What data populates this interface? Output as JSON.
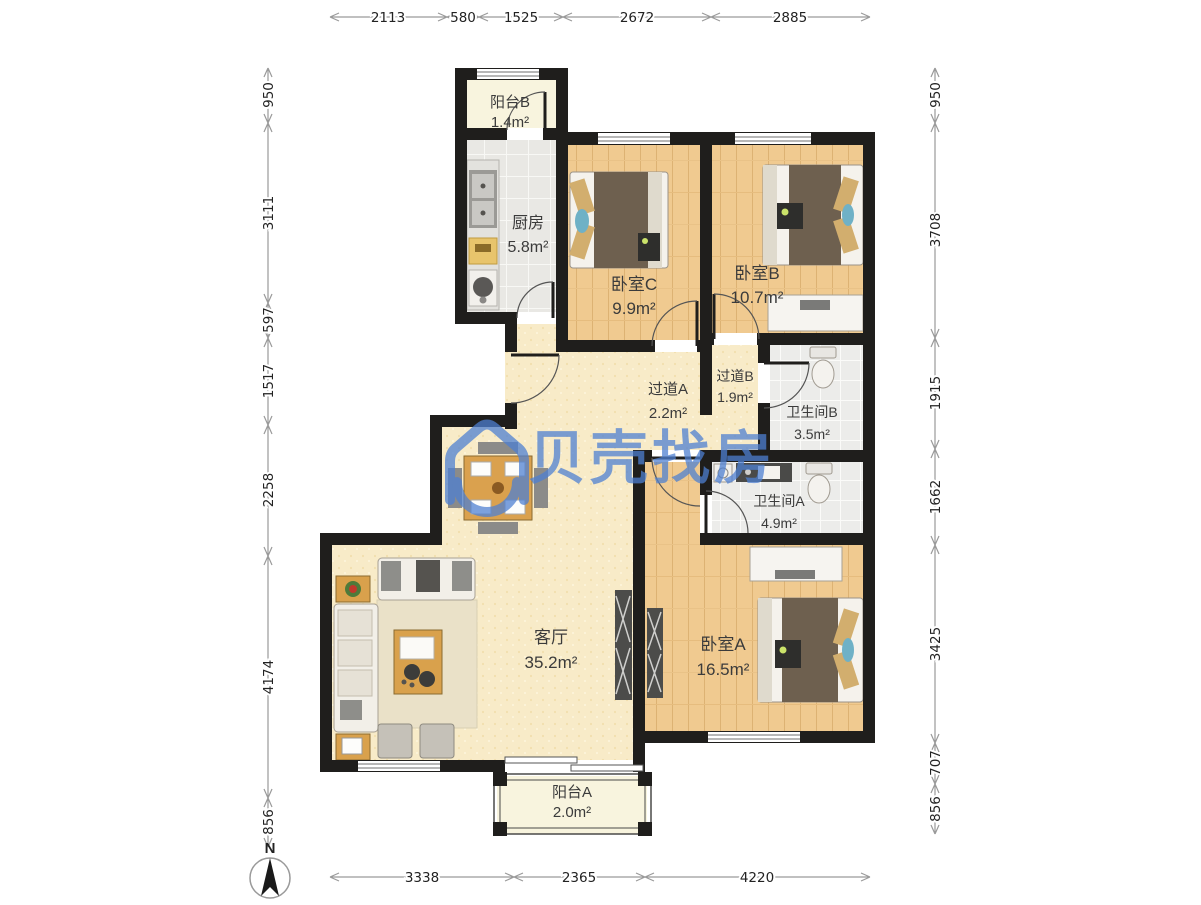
{
  "watermark": {
    "brand": "贝壳找房"
  },
  "compass": {
    "label": "N"
  },
  "rooms": [
    {
      "id": "balcony-b",
      "name": "阳台B",
      "area": "1.4m²"
    },
    {
      "id": "kitchen",
      "name": "厨房",
      "area": "5.8m²"
    },
    {
      "id": "bedroom-c",
      "name": "卧室C",
      "area": "9.9m²"
    },
    {
      "id": "bedroom-b",
      "name": "卧室B",
      "area": "10.7m²"
    },
    {
      "id": "hallway-a",
      "name": "过道A",
      "area": "2.2m²"
    },
    {
      "id": "hallway-b",
      "name": "过道B",
      "area": "1.9m²"
    },
    {
      "id": "bathroom-b",
      "name": "卫生间B",
      "area": "3.5m²"
    },
    {
      "id": "bathroom-a",
      "name": "卫生间A",
      "area": "4.9m²"
    },
    {
      "id": "living-room",
      "name": "客厅",
      "area": "35.2m²"
    },
    {
      "id": "bedroom-a",
      "name": "卧室A",
      "area": "16.5m²"
    },
    {
      "id": "balcony-a",
      "name": "阳台A",
      "area": "2.0m²"
    }
  ],
  "dimensions": {
    "top": [
      "2113",
      "580",
      "1525",
      "2672",
      "2885"
    ],
    "bottom": [
      "3338",
      "2365",
      "4220"
    ],
    "left": [
      "950",
      "3111",
      "597",
      "1517",
      "2258",
      "4174",
      "856"
    ],
    "right": [
      "950",
      "3708",
      "1915",
      "1662",
      "3425",
      "707",
      "856"
    ]
  }
}
